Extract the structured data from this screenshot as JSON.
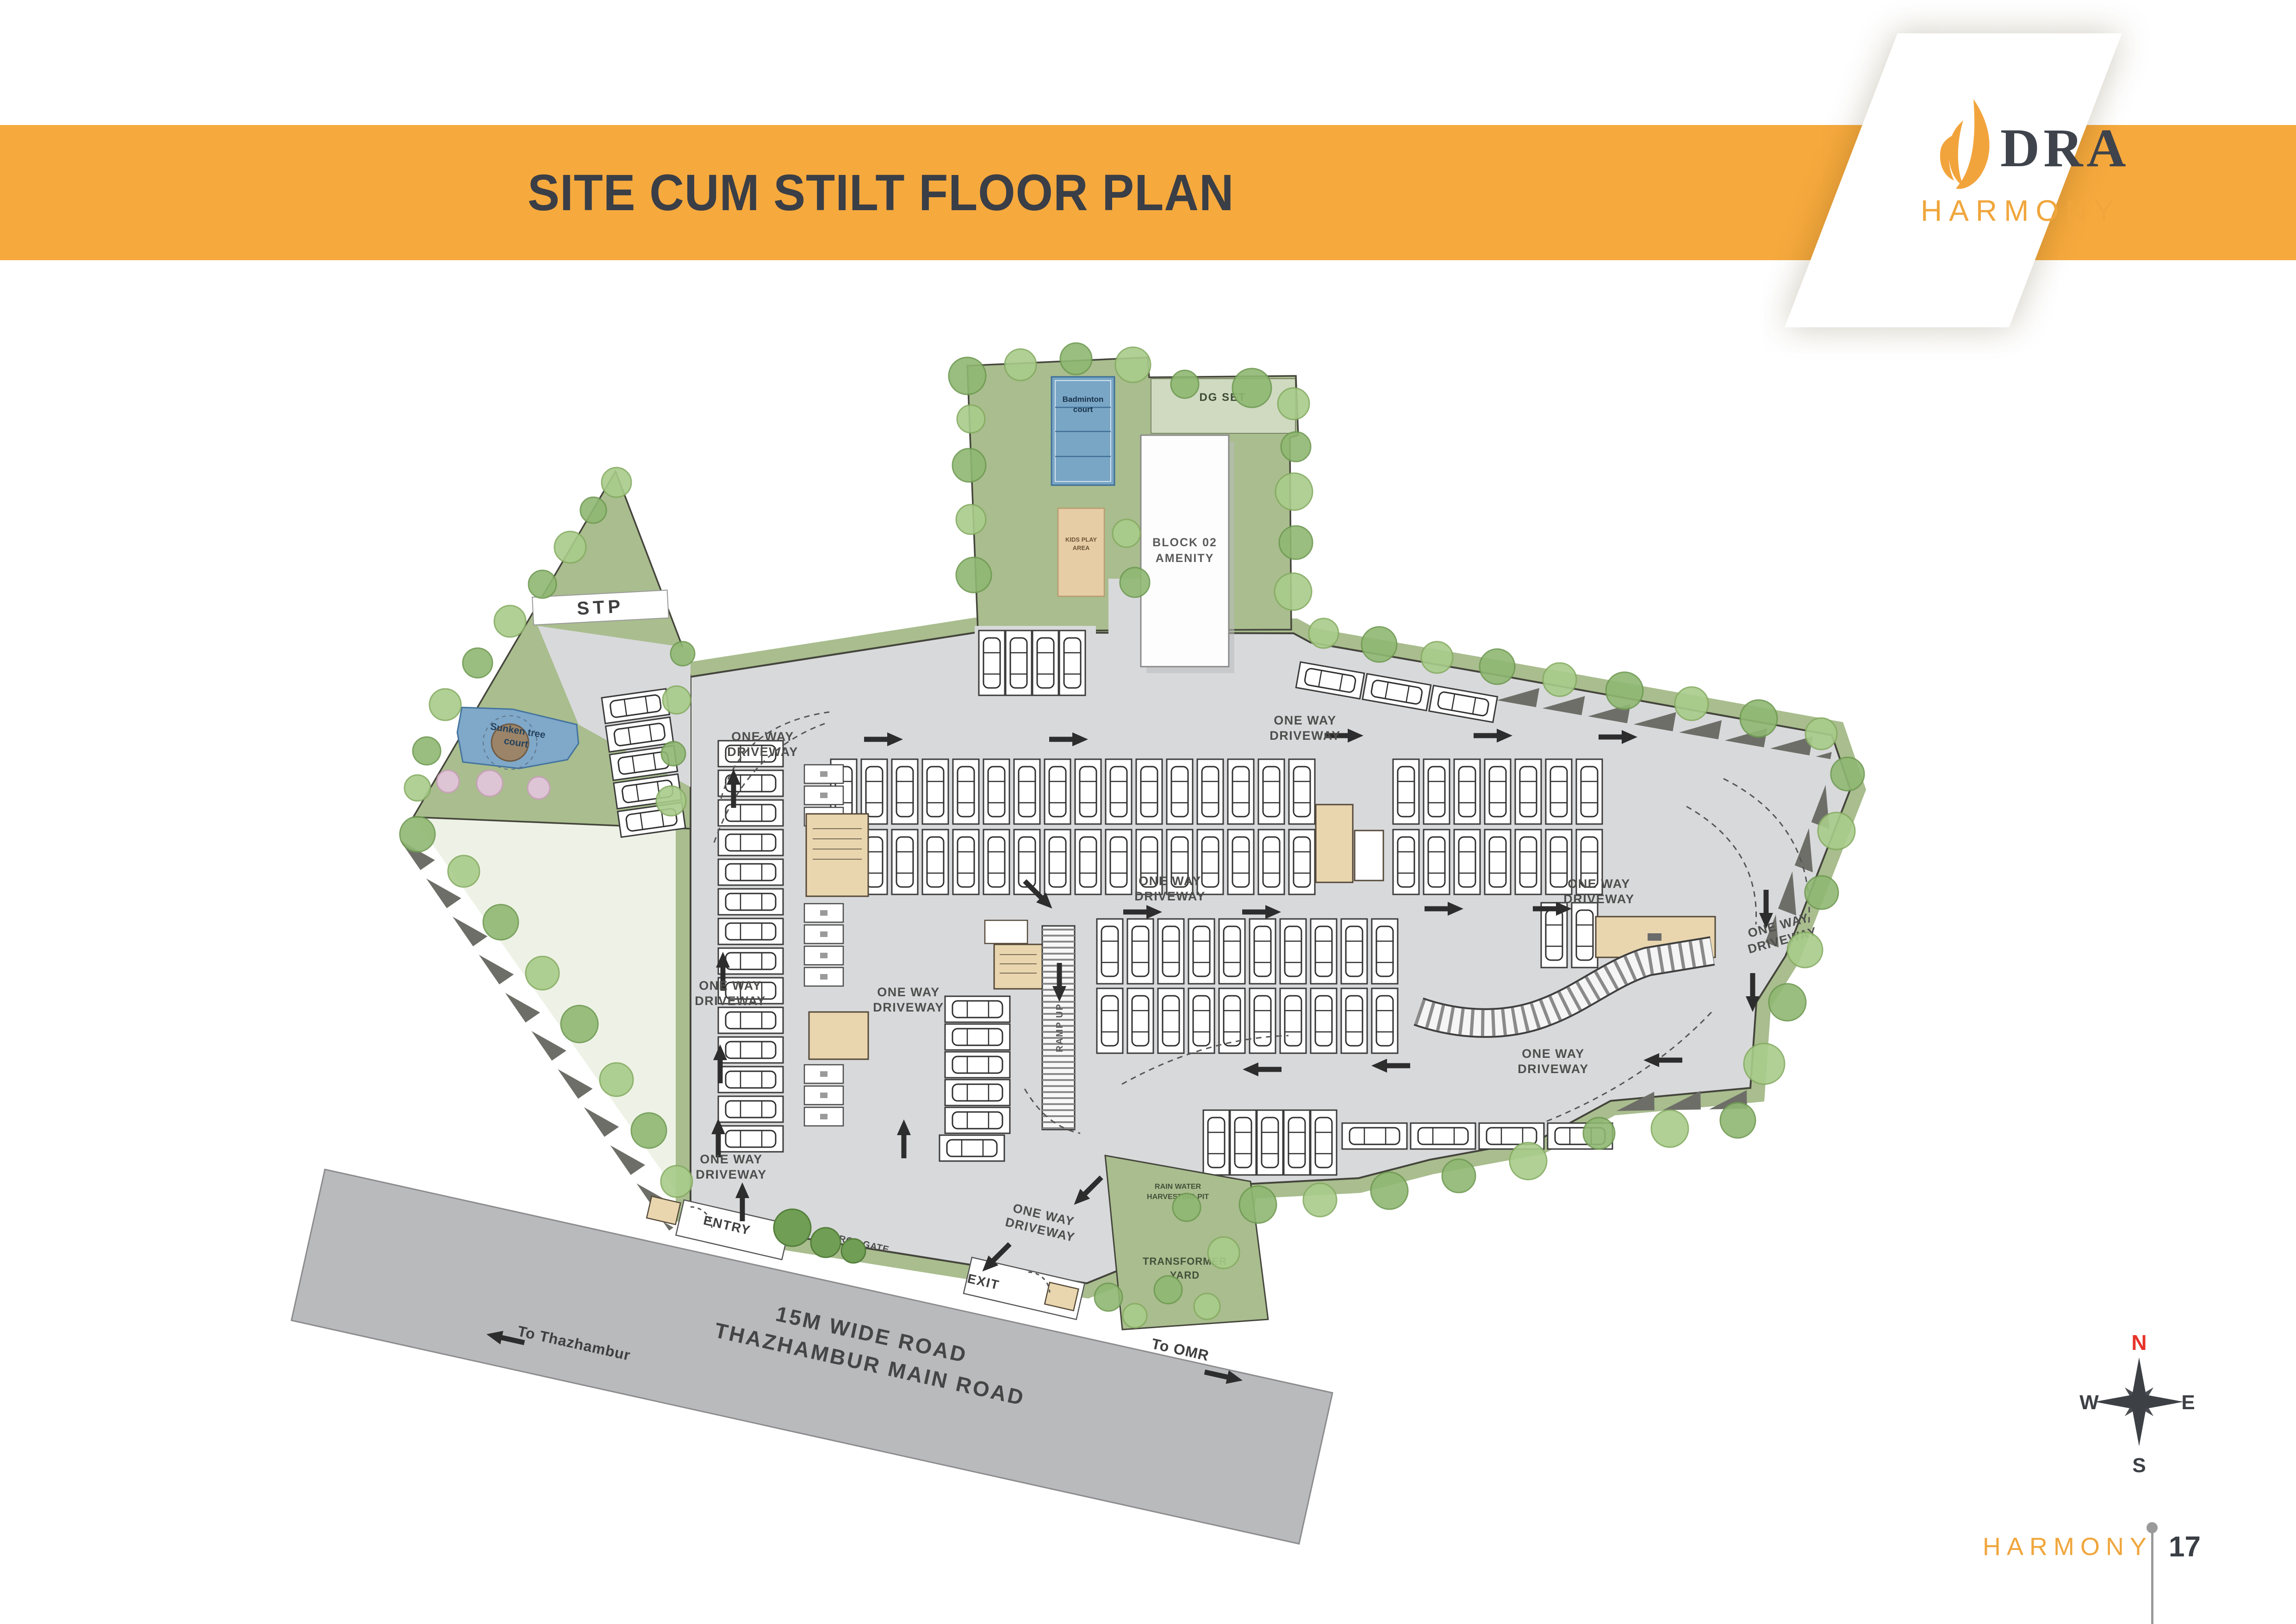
{
  "header": {
    "title": "SITE CUM STILT FLOOR PLAN"
  },
  "logo": {
    "brand": "DRA",
    "project": "HARMONY"
  },
  "plan": {
    "stp": "STP",
    "dg_set": "DG SET",
    "amenity_line1": "BLOCK 02",
    "amenity_line2": "AMENITY",
    "badminton_line1": "Badminton",
    "badminton_line2": "court",
    "sandpit_line1": "KIDS PLAY",
    "sandpit_line2": "AREA",
    "pond_line1": "Sunken tree",
    "pond_line2": "court",
    "one_way_line1": "ONE WAY",
    "one_way_line2": "DRIVEWAY",
    "ramp_label": "RAMP UP",
    "entry": "ENTRY",
    "exit": "EXIT",
    "arch_gate": "ARCH GATE",
    "transformer_line1": "TRANSFORMER",
    "transformer_line2": "YARD",
    "pit_line1": "RAIN WATER",
    "pit_line2": "HARVESTING PIT",
    "road_line1": "15M WIDE ROAD",
    "road_line2": "THAZHAMBUR MAIN ROAD",
    "to_thazhambur": "To  Thazhambur",
    "to_omr": "To  OMR"
  },
  "compass": {
    "n": "N",
    "e": "E",
    "s": "S",
    "w": "W"
  },
  "footer": {
    "brand": "HARMONY",
    "page": "17"
  }
}
